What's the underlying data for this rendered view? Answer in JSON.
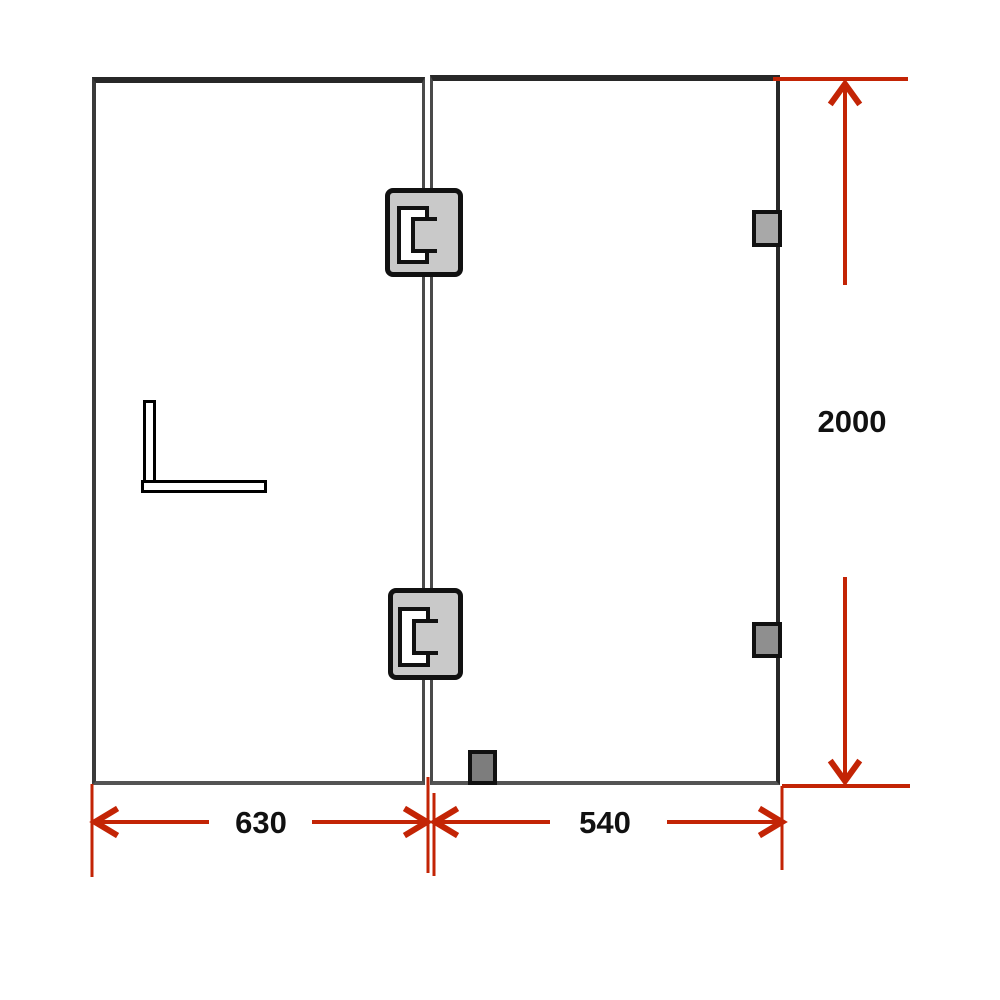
{
  "dimensions": {
    "left_panel_width": {
      "label": "630"
    },
    "right_panel_width": {
      "label": "540"
    },
    "panel_height": {
      "label": "2000"
    }
  },
  "colors": {
    "background": "#ffffff",
    "dimension_red": "#c32405",
    "border_dark": "#282828",
    "border_left": "#3a3a3a",
    "border_bottom": "#545454",
    "divider": "#4a4a4a",
    "outline_black": "#111111",
    "hinge_fill": "#c9c9c9",
    "wall_bracket_upper_fill": "#a8a8a8",
    "wall_bracket_lower_fill": "#8f8f8f",
    "floor_stop_fill": "#7d7d7d"
  },
  "components": {
    "left_panel": "fixed glass panel",
    "right_panel": "glass door panel",
    "top_hinge": "glass-to-glass hinge",
    "bottom_hinge": "glass-to-glass hinge",
    "wall_bracket_upper": "wall mounting bracket",
    "wall_bracket_lower": "wall mounting bracket",
    "floor_stop": "floor bracket",
    "l_bracket": "L-shaped support bracket"
  }
}
